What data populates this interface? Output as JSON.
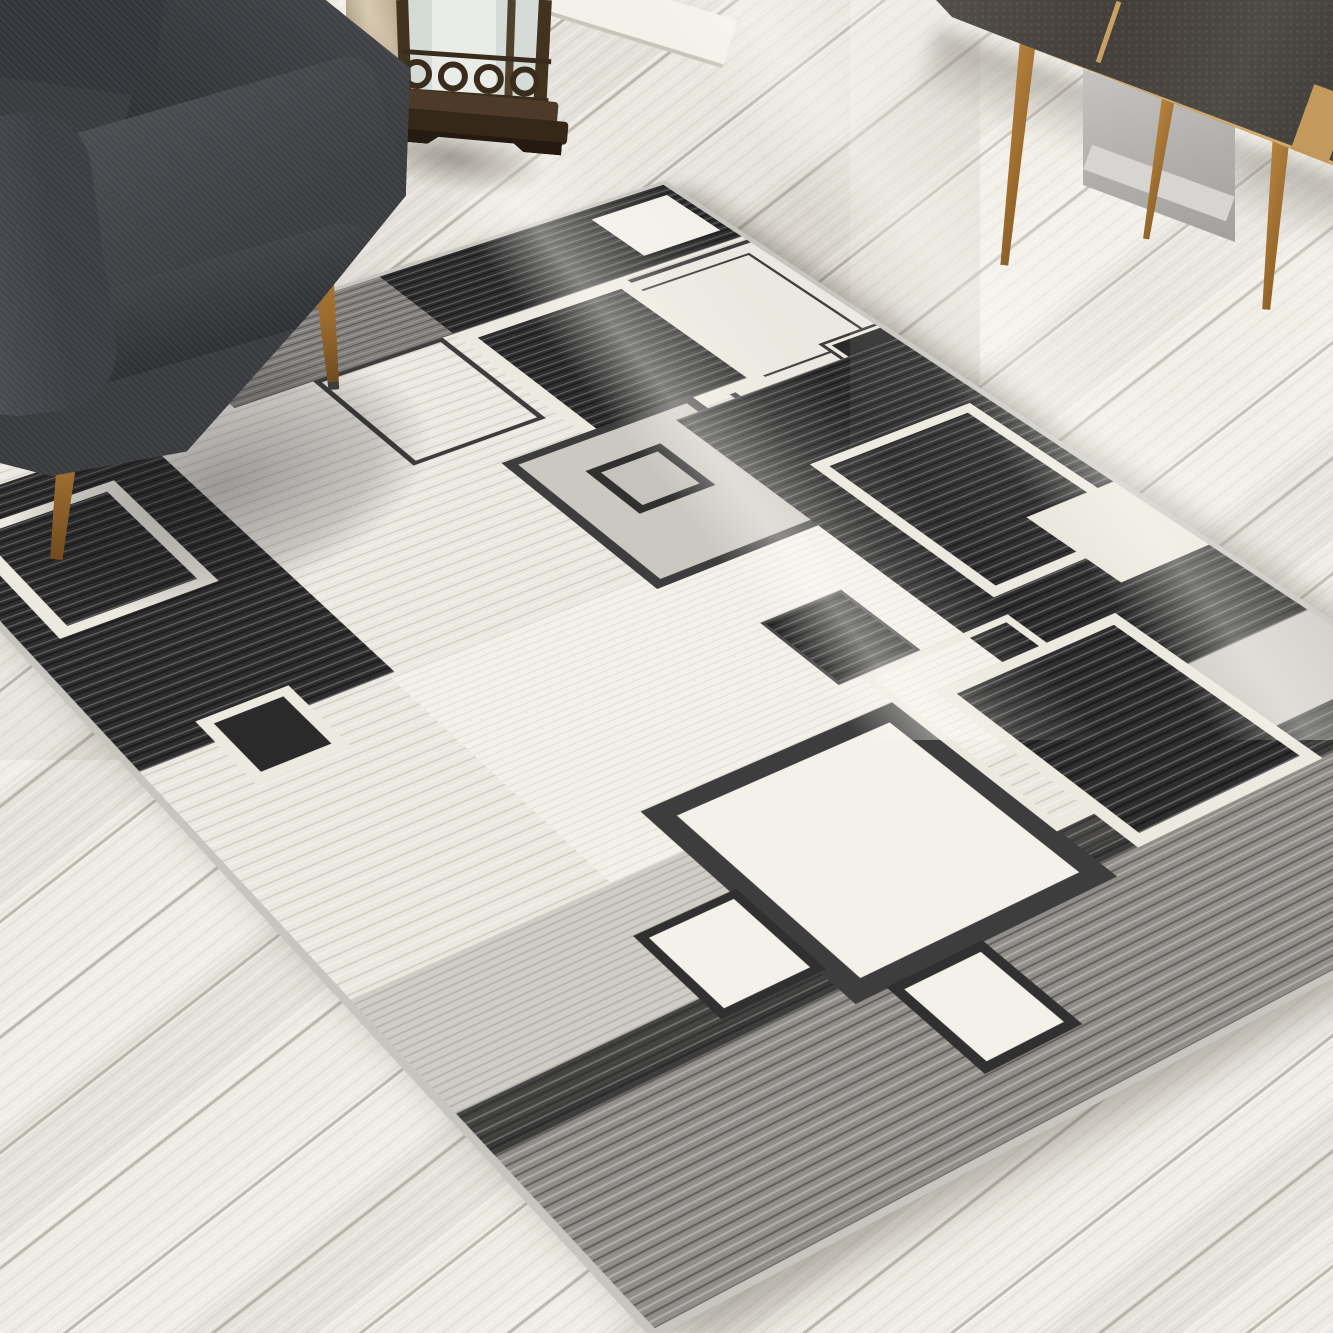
{
  "meta": {
    "image_type": "photograph",
    "subject": "Modern geometric area rug styled in a living room",
    "description": "A grey, black and cream contemporary rug with overlapping square motifs lies diagonally on a whitewashed wood plank floor. A dark charcoal fabric armchair with tapered wood legs sits at top left, a bronze candle lantern stands against the wall at top center, and a mid-century sideboard with dark stone-look doors, oak frame and splayed oak legs stands at top right. Sunlight streaks fall across the floor from the upper right."
  },
  "palette": {
    "floor_base": "#eae7e1",
    "floor_light": "#f0ede7",
    "floor_mid": "#e5e2db",
    "floor_light2": "#eeebe4",
    "baseboard": "#f3f1ea",
    "trim_wood": "#bca581",
    "rug_binding": "#c7c5c0",
    "rug_cream": "#ebe8e1",
    "rug_cream2": "#eae7de",
    "rug_white": "#f3f1ea",
    "rug_black": "#2e2e2e",
    "rug_black2": "#2a2a2a",
    "rug_grey": "#918e8a",
    "rug_grey2": "#cfccc6",
    "rug_grey3": "#cbc8c2",
    "rug_grey4": "#c6c3bd",
    "rug_line": "#3d3d3d",
    "rug_line2": "#303030",
    "rug_border_cream": "#ece9e0",
    "chair_fabric": "#393b3f",
    "leg_wood": "#9c6c2f",
    "cab_panel": "#443f3b",
    "cab_oak": "#c49a5c",
    "wall_grey": "#b4b2af",
    "lantern_bronze": "#42331f",
    "lantern_glass": "#d5dbd7",
    "candle": "#eaece7",
    "sunlight": "rgba(255,253,247,0.4)"
  },
  "scene": {
    "objects": [
      {
        "name": "wood-floor",
        "label": "whitewashed diagonal plank flooring"
      },
      {
        "name": "area-rug",
        "label": "geometric squares rug in grey, black and cream"
      },
      {
        "name": "armchair",
        "label": "charcoal fabric mid-century armchair"
      },
      {
        "name": "candle-lantern",
        "label": "bronze metal lantern with frosted glass and candle"
      },
      {
        "name": "sideboard",
        "label": "oak sideboard with dark stone-look door panels"
      },
      {
        "name": "sunbeams",
        "label": "diagonal window light on floor"
      }
    ]
  }
}
